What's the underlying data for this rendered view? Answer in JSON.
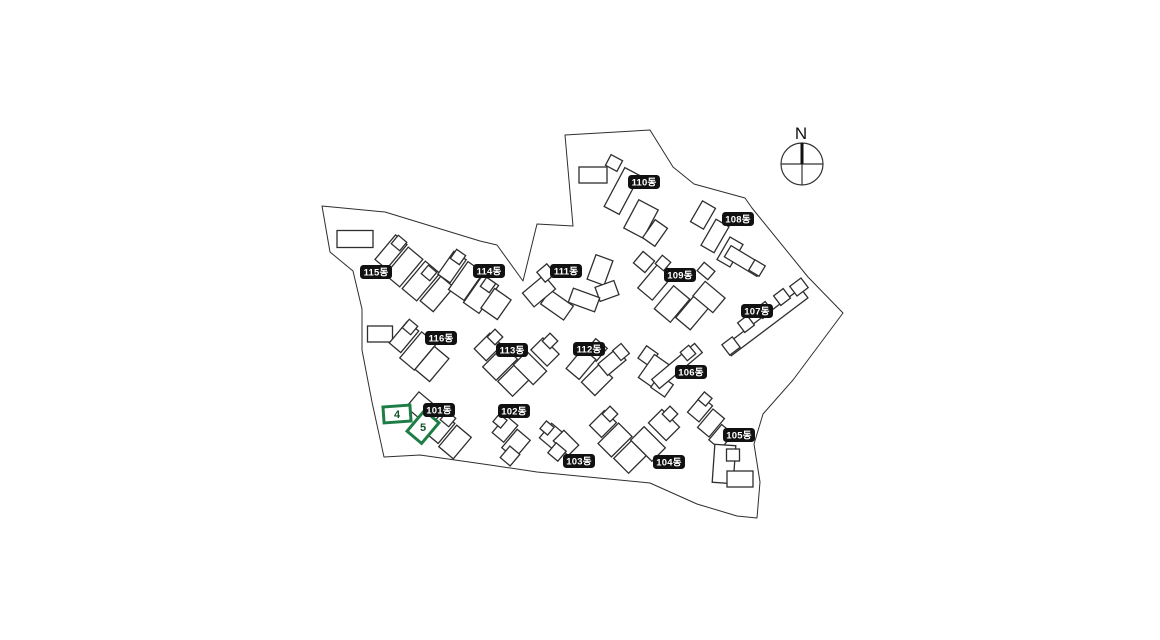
{
  "page": {
    "background": "#ffffff"
  },
  "map": {
    "compass_label": "N",
    "colors": {
      "outline": "#2e2e2e",
      "badge_bg": "#111111",
      "badge_text": "#ffffff",
      "highlight": "#1E7D46"
    },
    "highlight": {
      "units": [
        {
          "label": "4"
        },
        {
          "label": "5"
        }
      ]
    },
    "buildings": {
      "101": {
        "label": "101동"
      },
      "102": {
        "label": "102동"
      },
      "103": {
        "label": "103동"
      },
      "104": {
        "label": "104동"
      },
      "105": {
        "label": "105동"
      },
      "106": {
        "label": "106동"
      },
      "107": {
        "label": "107동"
      },
      "108": {
        "label": "108동"
      },
      "109": {
        "label": "109동"
      },
      "110": {
        "label": "110동"
      },
      "111": {
        "label": "111동"
      },
      "112": {
        "label": "112동"
      },
      "113": {
        "label": "113동"
      },
      "114": {
        "label": "114동"
      },
      "115": {
        "label": "115동"
      },
      "116": {
        "label": "116동"
      }
    }
  }
}
